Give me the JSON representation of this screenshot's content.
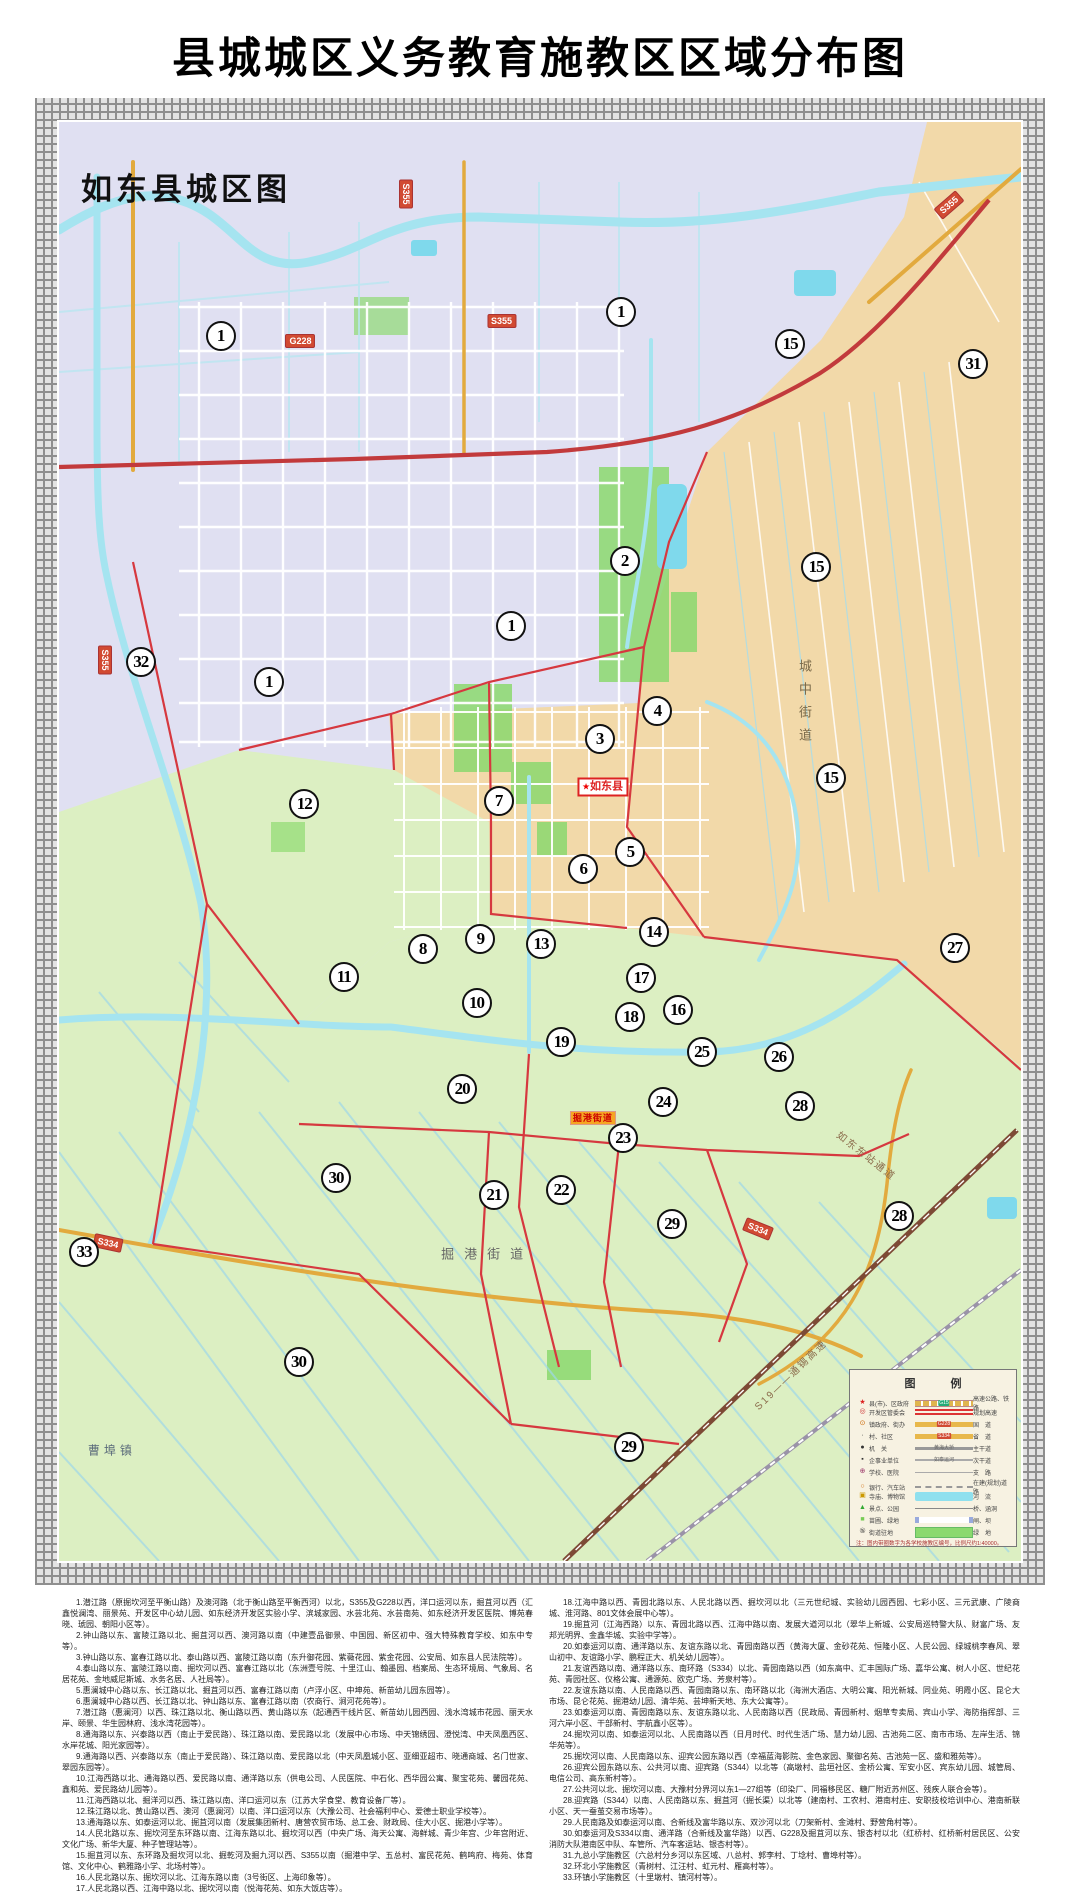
{
  "page": {
    "title": "县城城区义务教育施教区区域分布图"
  },
  "map": {
    "corner_label": "如东县城区图",
    "labels": [
      {
        "t": "城中街道",
        "x": 77.5,
        "y": 40.5,
        "cls": "v-street",
        "rot": 0,
        "name": "area-label-chengzhong-jiedao"
      },
      {
        "t": "掘港街道",
        "x": 44.5,
        "y": 78.6,
        "cls": "h-street",
        "rot": 0,
        "name": "area-label-juegang-jiedao"
      },
      {
        "t": "曹埠镇",
        "x": 5.5,
        "y": 92.3,
        "cls": "town",
        "rot": 0,
        "name": "area-label-caobu-town"
      },
      {
        "t": "如东东站通道",
        "x": 84.0,
        "y": 71.8,
        "cls": "roadname",
        "rot": 38,
        "name": "road-label-rudong-east-station"
      },
      {
        "t": "S19——通锡高速",
        "x": 76.0,
        "y": 87.0,
        "cls": "roadname",
        "rot": -44,
        "name": "road-label-s19-expressway"
      },
      {
        "t": "掘港街道",
        "x": 55.5,
        "y": 69.2,
        "cls": "seat",
        "rot": 0,
        "name": "seat-badge-juegang-jiedao"
      }
    ],
    "county_badge": {
      "star": "★",
      "t": "如东县",
      "x": 56.5,
      "y": 46.2
    },
    "road_badges": [
      {
        "t": "S355",
        "x": 36.1,
        "y": 5.0,
        "rot": 90
      },
      {
        "t": "S355",
        "x": 4.8,
        "y": 37.4,
        "rot": 90
      },
      {
        "t": "S355",
        "x": 46.0,
        "y": 13.8,
        "rot": 0
      },
      {
        "t": "G228",
        "x": 25.1,
        "y": 15.2,
        "rot": 0
      },
      {
        "t": "S355",
        "x": 92.5,
        "y": 5.8,
        "rot": -41
      },
      {
        "t": "S334",
        "x": 5.1,
        "y": 77.9,
        "rot": 12
      },
      {
        "t": "S334",
        "x": 72.7,
        "y": 76.9,
        "rot": 22
      }
    ],
    "markers": [
      {
        "n": "1",
        "x": 16.8,
        "y": 14.9
      },
      {
        "n": "1",
        "x": 58.4,
        "y": 13.2
      },
      {
        "n": "15",
        "x": 76.0,
        "y": 15.4
      },
      {
        "n": "31",
        "x": 95.0,
        "y": 16.8
      },
      {
        "n": "2",
        "x": 58.8,
        "y": 30.5
      },
      {
        "n": "15",
        "x": 78.7,
        "y": 30.9
      },
      {
        "n": "32",
        "x": 8.5,
        "y": 37.5
      },
      {
        "n": "1",
        "x": 21.8,
        "y": 38.9
      },
      {
        "n": "1",
        "x": 47.0,
        "y": 35.0
      },
      {
        "n": "4",
        "x": 62.2,
        "y": 40.9
      },
      {
        "n": "3",
        "x": 56.2,
        "y": 42.9
      },
      {
        "n": "15",
        "x": 80.2,
        "y": 45.6
      },
      {
        "n": "12",
        "x": 25.5,
        "y": 47.4
      },
      {
        "n": "7",
        "x": 45.7,
        "y": 47.2
      },
      {
        "n": "5",
        "x": 59.4,
        "y": 50.7
      },
      {
        "n": "6",
        "x": 54.5,
        "y": 51.9
      },
      {
        "n": "8",
        "x": 37.8,
        "y": 57.5
      },
      {
        "n": "9",
        "x": 43.8,
        "y": 56.8
      },
      {
        "n": "13",
        "x": 50.1,
        "y": 57.1
      },
      {
        "n": "14",
        "x": 61.8,
        "y": 56.3
      },
      {
        "n": "27",
        "x": 93.1,
        "y": 57.4
      },
      {
        "n": "11",
        "x": 29.6,
        "y": 59.4
      },
      {
        "n": "17",
        "x": 60.5,
        "y": 59.5
      },
      {
        "n": "10",
        "x": 43.4,
        "y": 61.2
      },
      {
        "n": "18",
        "x": 59.4,
        "y": 62.2
      },
      {
        "n": "16",
        "x": 64.3,
        "y": 61.7
      },
      {
        "n": "19",
        "x": 52.2,
        "y": 63.9
      },
      {
        "n": "25",
        "x": 66.8,
        "y": 64.6
      },
      {
        "n": "26",
        "x": 74.8,
        "y": 65.0
      },
      {
        "n": "20",
        "x": 41.9,
        "y": 67.2
      },
      {
        "n": "24",
        "x": 62.8,
        "y": 68.1
      },
      {
        "n": "28",
        "x": 77.0,
        "y": 68.4
      },
      {
        "n": "23",
        "x": 58.6,
        "y": 70.6
      },
      {
        "n": "30",
        "x": 28.8,
        "y": 73.4
      },
      {
        "n": "21",
        "x": 45.2,
        "y": 74.6
      },
      {
        "n": "22",
        "x": 52.2,
        "y": 74.2
      },
      {
        "n": "29",
        "x": 63.7,
        "y": 76.6
      },
      {
        "n": "28",
        "x": 87.3,
        "y": 76.0
      },
      {
        "n": "33",
        "x": 2.6,
        "y": 78.5
      },
      {
        "n": "30",
        "x": 24.9,
        "y": 86.2
      },
      {
        "n": "29",
        "x": 59.2,
        "y": 92.1
      }
    ],
    "legend": {
      "title": "图　例",
      "rows": [
        {
          "sym": "★",
          "sc": "#d22",
          "label": "县(市)、区政府",
          "mid": "G15",
          "midType": "l-highway",
          "tag": "t-green",
          "right": "高速公路、铁路"
        },
        {
          "sym": "◎",
          "sc": "#c33",
          "label": "开发区管委会",
          "mid": "",
          "midType": "l-planned",
          "tag": "",
          "right": "规划高速"
        },
        {
          "sym": "⊙",
          "sc": "#c60",
          "label": "镇政府、街办",
          "mid": "G228",
          "midType": "l-road",
          "tag": "t-red",
          "right": "国　道"
        },
        {
          "sym": "·",
          "sc": "#333",
          "label": "村、社区",
          "mid": "S334",
          "midType": "l-road",
          "tag": "t-red",
          "right": "省　道"
        },
        {
          "sym": "●",
          "sc": "#333",
          "label": "机　关",
          "mid": "黄海大桥",
          "midType": "l-main",
          "tag": "t-plain",
          "right": "主干道"
        },
        {
          "sym": "▪",
          "sc": "#333",
          "label": "企事业单位",
          "mid": "如泰运河",
          "midType": "l-sub",
          "tag": "t-plain",
          "right": "次干道"
        },
        {
          "sym": "⊕",
          "sc": "#936",
          "label": "学校、医院",
          "mid": "",
          "midType": "l-branch",
          "tag": "",
          "right": "支　路"
        },
        {
          "sym": "○",
          "sc": "#c60",
          "label": "银行、汽车站",
          "mid": "",
          "midType": "l-dashed",
          "tag": "",
          "right": "在建(规划)道路"
        },
        {
          "sym": "▣",
          "sc": "#c90",
          "label": "寺庙、博物馆",
          "mid": "",
          "midType": "l-river",
          "tag": "",
          "right": "河　流"
        },
        {
          "sym": "▲",
          "sc": "#3a3",
          "label": "景点、公园",
          "mid": "",
          "midType": "l-thin",
          "tag": "",
          "right": "桥、涵洞"
        },
        {
          "sym": "■",
          "sc": "#7c5",
          "label": "苗圃、绿地",
          "mid": "",
          "midType": "l-gate",
          "tag": "",
          "right": "闸、坝"
        },
        {
          "sym": "⑤",
          "sc": "#333",
          "label": "街道驻地",
          "mid": "",
          "midType": "l-green",
          "tag": "",
          "right": "绿　地"
        }
      ],
      "note": "注：图内带圈数字为各学校施教区编号，比例尺约1∶40000。"
    }
  },
  "notes": {
    "left": [
      "1.潜江路（原掘坎河至平衡山路）及澳河路（北于衡山路至平衡西河）以北，S355及G228以西，洋口运河以东，掘苴河以西（汇鑫悦澜湾、丽景苑、开发区中心幼儿园、如东经济开发区实验小学、滨城家园、水芸北苑、水芸南苑、如东经济开发区医院、博苑春晓、琥园、朝阳小区等）。",
      "2.钟山路以东、富陵江路以北、掘苴河以西、澳河路以南（中建壹品御景、中国园、新区初中、强大特殊教育学校、如东中专等）。",
      "3.钟山路以东、富春江路以北、泰山路以西、富陵江路以南（东升御花园、紫薇花园、紫金花园、公安局、如东县人民法院等）。",
      "4.泰山路以东、富陵江路以南、掘坎河以西、富春江路以北（东洲壹号院、十里江山、翰墨园、档案局、生态环境局、气象局、名居花苑、金地威尼斯城、水务名居、人社局等）。",
      "5.惠澜城中心路以东、长江路以北、掘苴河以西、富春江路以南（卢浮小区、中坤苑、新苗幼儿园东园等）。",
      "6.惠澜城中心路以西、长江路以北、钟山路以东、富春江路以南（农商行、涧河花苑等）。",
      "7.潜江路（惠澜河）以西、珠江路以北、衡山路以西、黄山路以东（起通西干线片区、新苗幼儿园西园、浅水湾城市花园、丽天水岸、颐景、华生园林府、浅水湾花园等）。",
      "8.通海路以东、兴泰路以西（南止于爱民路）、珠江路以南、爱民路以北（发展中心市场、中天锦绣园、澄悦湾、中天凤凰西区、水岸花城、阳光家园等）。",
      "9.通海路以西、兴泰路以东（南止于爱民路）、珠江路以南、爱民路以北（中天凤凰城小区、亚细亚超市、晓通商城、名门世家、翠园东园等）。",
      "10.江海西路以北、通海路以西、爱民路以南、通洋路以东（供电公司、人民医院、中石化、西华园公寓、聚宝花苑、馨园花苑、鑫和苑、爱民路幼儿园等）。",
      "11.江海西路以北、掘洋河以西、珠江路以南、洋口运河以东（江苏大学食堂、教育设备厂等）。",
      "12.珠江路以北、黄山路以西、澳河（惠澜河）以南、洋口运河以东（大豫公司、社会福利中心、爱德士职业学校等）。",
      "13.通海路以东、如泰运河以北、掘苴河以南（发展集团新村、唐营农贸市场、总工会、财政局、佳大小区、掘港小学等）。",
      "14.人民北路以东、掘坎河至东环路以南、江海东路以北、掘坎河以西（中央广场、海天公寓、海鲜城、青少年宫、少年宫附近、文化广场、新华大厦、种子管理站等）。",
      "15.掘苴河以东、东环路及掘坎河以北、掘乾河及掘九河以西、S355以南（掘港中学、五总村、富民花苑、鹤鸣府、梅苑、体育馆、文化中心、鹤雅路小学、北场村等）。",
      "16.人民北路以东、掘坎河以北、江海东路以南（3号街区、上海印象等）。",
      "17.人民北路以西、江海中路以北、掘坎河以南（悦海花苑、如东大饭店等）。"
    ],
    "right": [
      "18.江海中路以西、青园北路以东、人民北路以西、掘坎河以北（三元世纪城、实验幼儿园西园、七彩小区、三元武康、广陵商城、淮河路、801文体会展中心等）。",
      "19.掘苴河（江海西路）以东、青园北路以西、江海中路以南、发展大道河以北（翠华上新城、公安局巡特警大队、财富广场、友邦光明界、金鑫华城、实验中学等）。",
      "20.如泰运河以南、通洋路以东、友谊东路以北、青园南路以西（黄海大厦、金砂花苑、恒隆小区、人民公园、绿城桃李春风、翠山初中、友谊路小学、鹏程正大、机关幼儿园等）。",
      "21.友谊西路以南、通洋路以东、南环路（S334）以北、青园南路以西（如东高中、汇丰国际广场、嘉华公寓、树人小区、世纪花苑、青园社区、仪格公寓、通源苑、欧克广场、芳泉村等）。",
      "22.友谊东路以南、人民南路以西、青园南路以东、南环路以北（海洲大酒店、大明公寓、阳光新城、同业苑、明霞小区、昆仑大市场、昆仑花苑、掘港幼儿园、清华苑、芸坤新天地、东大公寓等）。",
      "23.如泰运河以南、青园南路以东、友谊东路以北、人民南路以西（民政局、青园新村、烟草专卖局、宾山小学、海防指挥部、三河六岸小区、干部新村、宇航鑫小区等）。",
      "24.掘坎河以南、如泰运河以北、人民南路以西（日月时代、时代生活广场、慧力幼儿园、古池苑二区、南市市场、左岸生活、锦华苑等）。",
      "25.掘坎河以南、人民南路以东、迎宾公园东路以西（幸福蓝海影院、金色家园、聚御名苑、古池苑一区、盛和雅苑等）。",
      "26.迎宾公园东路以东、公共河以南、迎宾路（S344）以北等（高墩村、盐垣社区、金桥公寓、军安小区、宾东幼儿园、城管局、电信公司、高东新村等）。",
      "27.公共河以北、掘坎河以南、大豫村分界河以东1—27组等（印染厂、同福移民区、糖厂附近苏州区、残疾人联合会等）。",
      "28.迎宾路（S344）以南、人民南路以东、掘苴河（掘长渠）以北等（建南村、工农村、港南村庄、安职技校培训中心、港南新联小区、天一蚕茧交易市场等）。",
      "29.人民南路及如泰运河以南、合新线及富华路以东、双沙河以北（刀架新村、金滩村、野营角村等）。",
      "30.如泰运河及S334以南、通洋路（合新线及富华路）以西、G228及掘苴河以东、银杏村以北（红桥村、红桥新村居民区、公安消防大队港南区中队、车管所、汽车客运站、银杏村等）。",
      "31.九总小学施教区（六总村分乡河以东区域、八总村、郭李村、丁埝村、曹埠村等）。",
      "32.环北小学施教区（青树村、江汪村、虹元村、雁高村等）。",
      "33.环镇小学施教区（十里墩村、镇河村等）。"
    ]
  }
}
